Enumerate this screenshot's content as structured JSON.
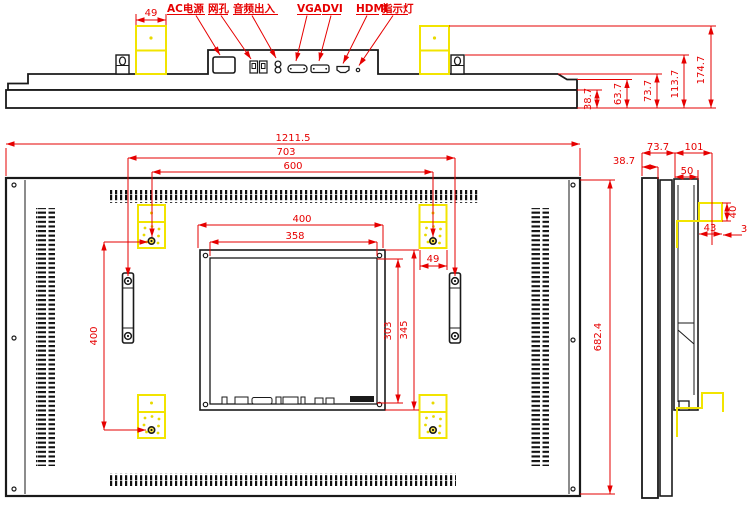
{
  "title": "LCD monitor outline dimension drawing",
  "colors": {
    "dimension_red": "#e60000",
    "bracket_yellow": "#f2e400",
    "line_black": "#1a1a1a",
    "background": "#ffffff"
  },
  "top_view": {
    "port_labels": [
      {
        "label": "AC电源"
      },
      {
        "label": "网孔"
      },
      {
        "label": "音频出入"
      },
      {
        "label": "VGA"
      },
      {
        "label": "DVI"
      },
      {
        "label": "HDMI"
      },
      {
        "label": "指示灯"
      }
    ],
    "dims": {
      "bracket_width": "49",
      "bezel_depth": "38.7",
      "step_depth": "63.7",
      "chassis_depth": "73.7",
      "hook_depth": "113.7",
      "bracket_depth": "174.7"
    }
  },
  "rear_view": {
    "dims": {
      "overall_width": "1211.5",
      "handle_hole_span": "703",
      "bracket_hole_span": "600",
      "plate_width": "400",
      "plate_inner_width": "358",
      "bracket_width": "49",
      "bracket_hole_vspan": "400",
      "plate_inner_height": "303",
      "plate_height": "345",
      "overall_height": "682.4"
    }
  },
  "side_view": {
    "dims": {
      "chassis_depth": "73.7",
      "total_depth": "101",
      "bezel_depth": "38.7",
      "rear_box_depth": "50",
      "hook_width": "43",
      "hook_height": "40",
      "hook_gap": "3"
    }
  }
}
